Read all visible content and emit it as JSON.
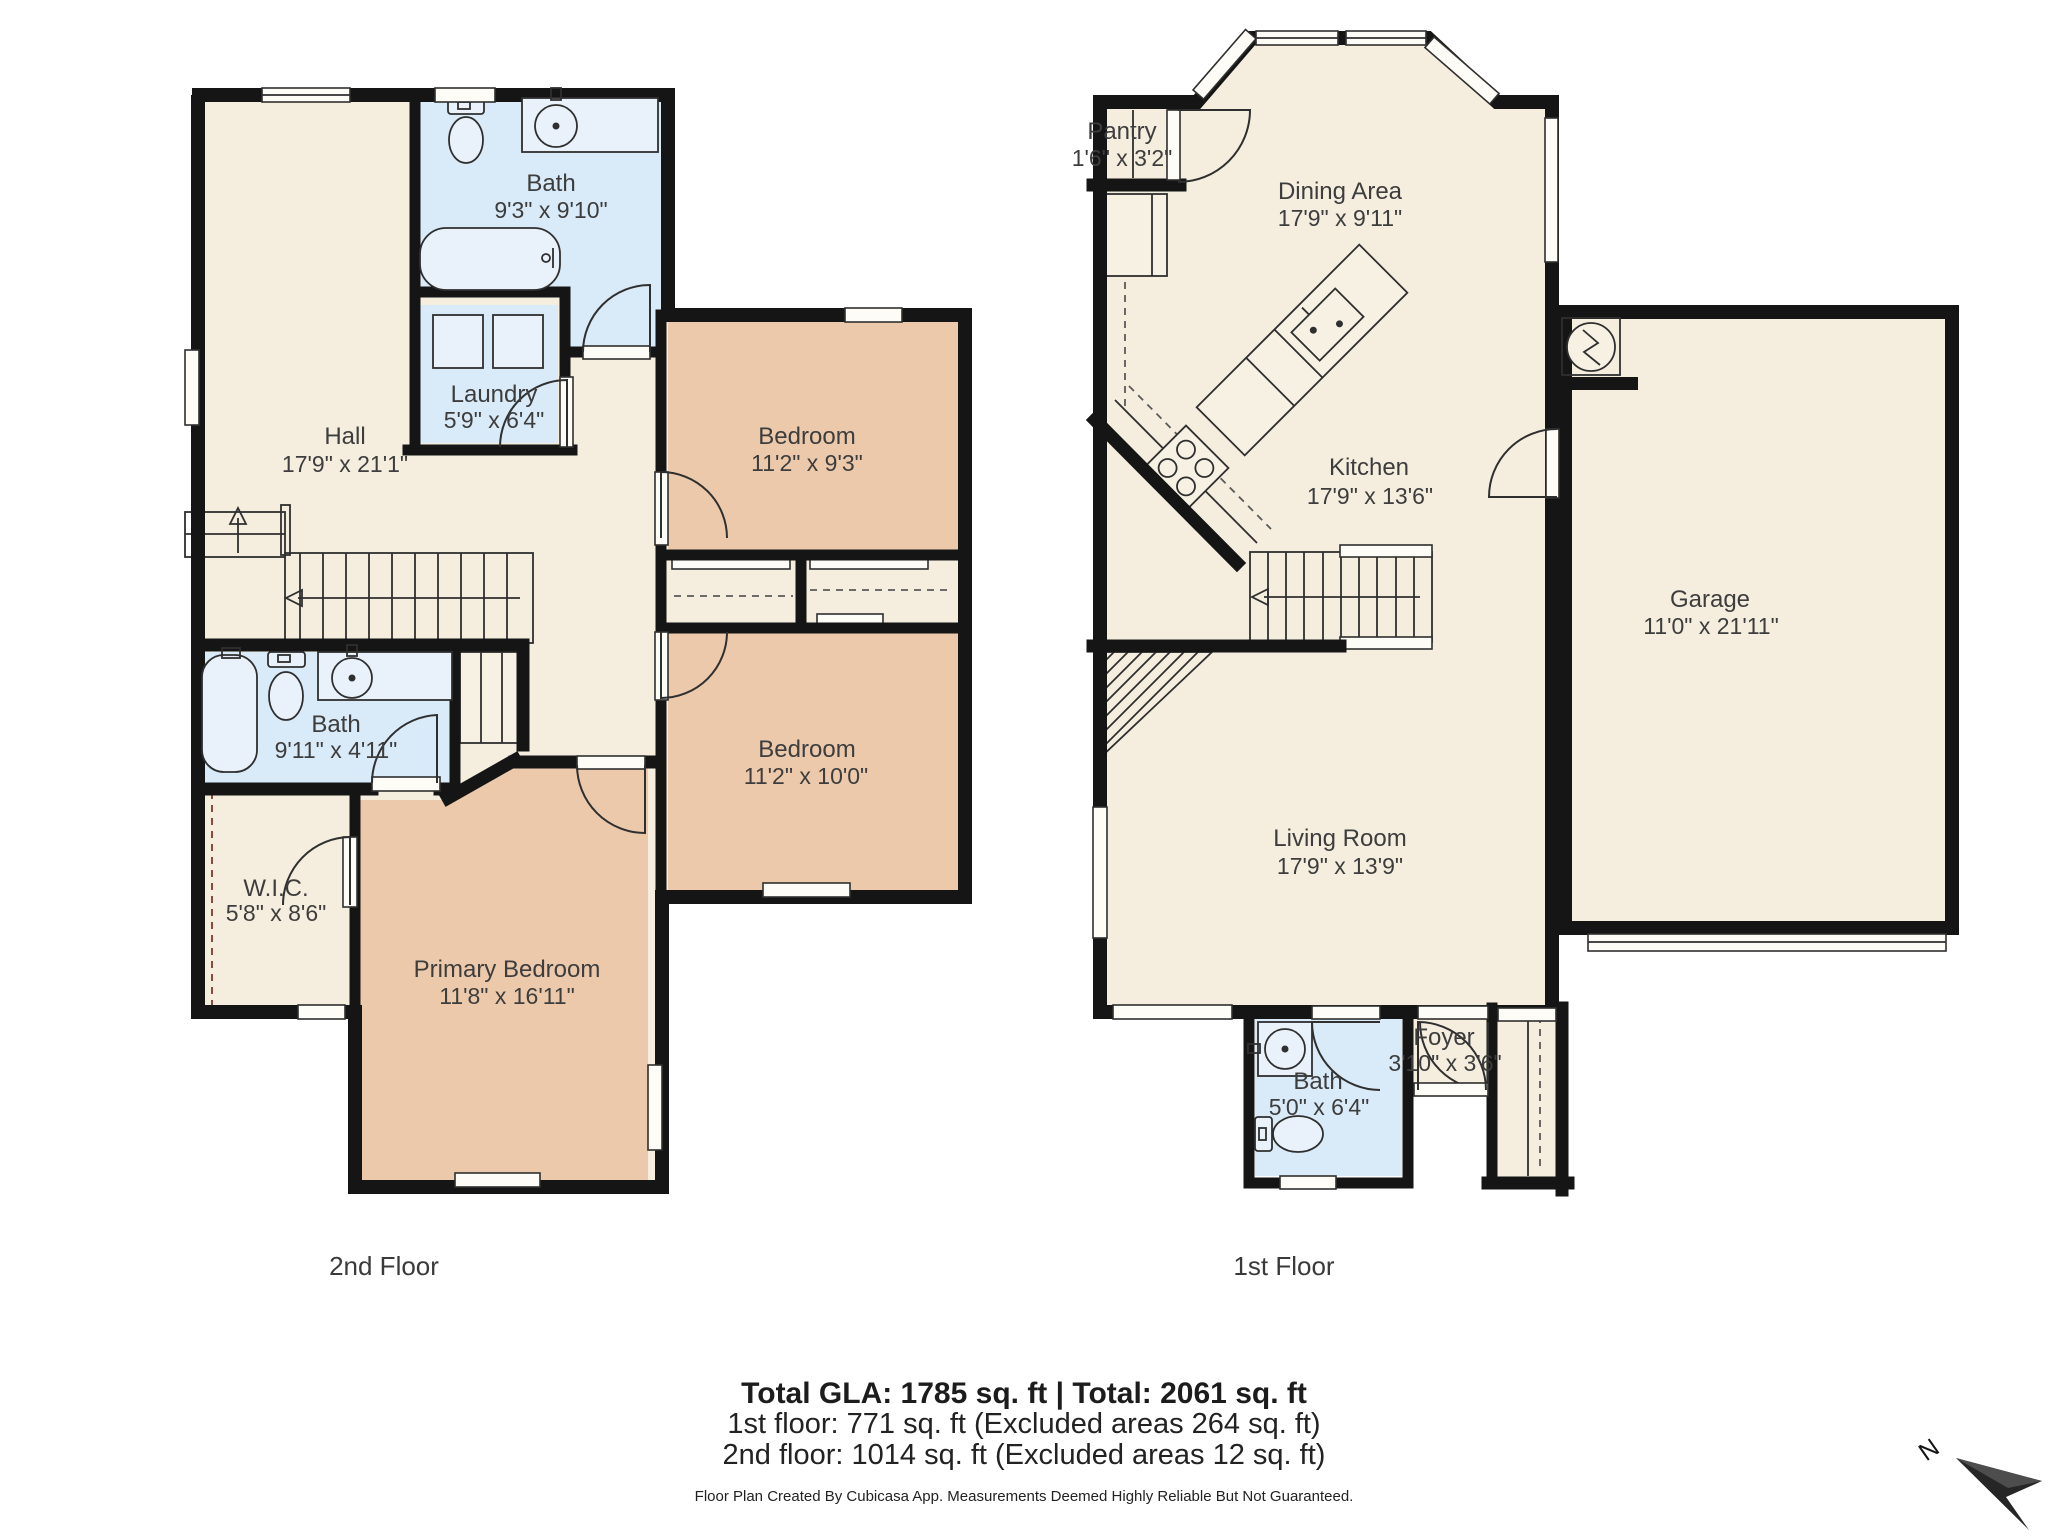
{
  "title": "Cubicasa floor plan",
  "floors": [
    {
      "label": "2nd Floor",
      "rooms": {
        "hall": {
          "name": "Hall",
          "dims": "17'9\" x 21'1\""
        },
        "bath": {
          "name": "Bath",
          "dims": "9'3\" x 9'10\""
        },
        "laundry": {
          "name": "Laundry",
          "dims": "5'9\" x 6'4\""
        },
        "bedroom1": {
          "name": "Bedroom",
          "dims": "11'2\" x 9'3\""
        },
        "bedroom2": {
          "name": "Bedroom",
          "dims": "11'2\" x 10'0\""
        },
        "bath2": {
          "name": "Bath",
          "dims": "9'11\" x 4'11\""
        },
        "wic": {
          "name": "W.I.C.",
          "dims": "5'8\" x 8'6\""
        },
        "primary": {
          "name": "Primary Bedroom",
          "dims": "11'8\" x 16'11\""
        }
      }
    },
    {
      "label": "1st Floor",
      "rooms": {
        "pantry": {
          "name": "Pantry",
          "dims": "1'6\" x 3'2\""
        },
        "dining": {
          "name": "Dining Area",
          "dims": "17'9\" x 9'11\""
        },
        "kitchen": {
          "name": "Kitchen",
          "dims": "17'9\" x 13'6\""
        },
        "garage": {
          "name": "Garage",
          "dims": "11'0\" x 21'11\""
        },
        "living": {
          "name": "Living Room",
          "dims": "17'9\" x 13'9\""
        },
        "bath": {
          "name": "Bath",
          "dims": "5'0\" x 6'4\""
        },
        "foyer": {
          "name": "Foyer",
          "dims": "3'10\" x 3'6\""
        }
      }
    }
  ],
  "summary": {
    "total": "Total GLA: 1785 sq. ft | Total: 2061 sq. ft",
    "floor1": "1st floor: 771 sq. ft (Excluded areas 264 sq. ft)",
    "floor2": "2nd floor: 1014 sq. ft (Excluded areas 12 sq. ft)",
    "disclaimer": "Floor Plan Created By Cubicasa App. Measurements Deemed Highly Reliable But Not Guaranteed."
  },
  "compass": {
    "label": "N"
  },
  "colors": {
    "floor": "#F5EEDF",
    "bedroom": "#ECC9AB",
    "bath": "#D9EAF8",
    "wall": "#151515",
    "window": "#FDFCF6",
    "label_text": "#3D3D3D"
  }
}
